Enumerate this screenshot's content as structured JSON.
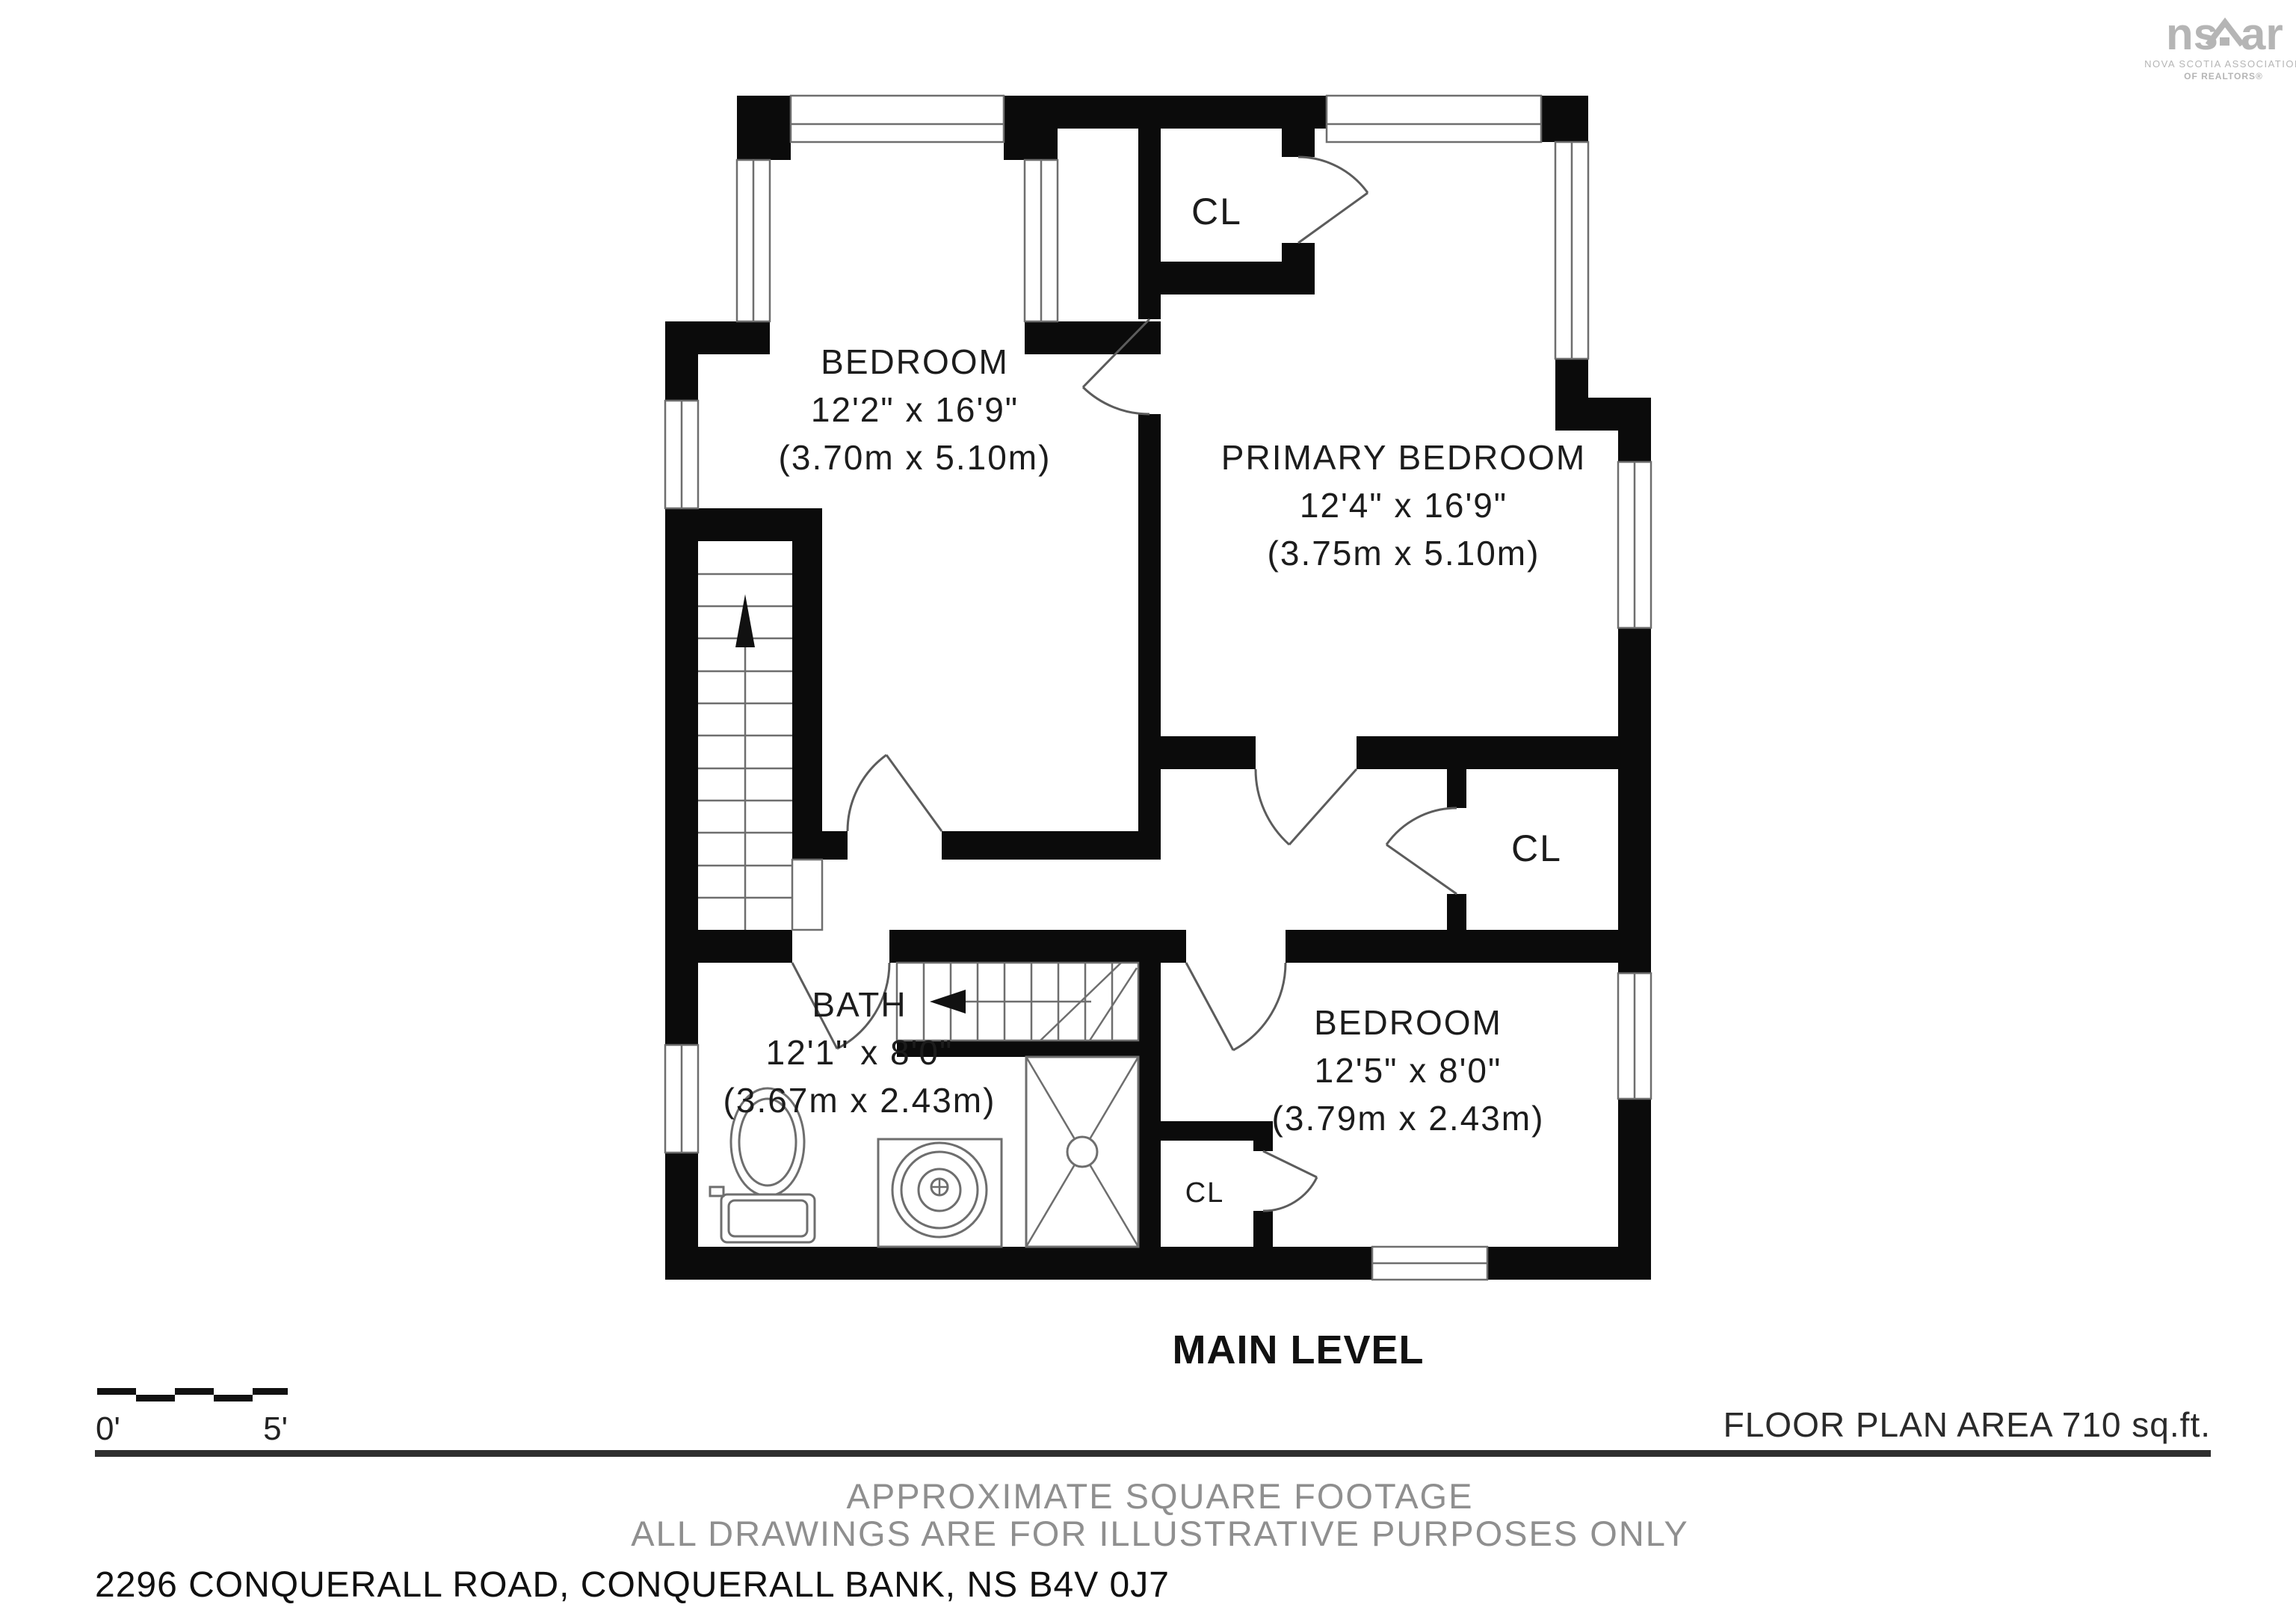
{
  "logo": {
    "brand_left": "ns",
    "brand_right": "ar",
    "caption_line1": "NOVA SCOTIA ASSOCIATION",
    "caption_line2": "OF REALTORS®"
  },
  "rooms": {
    "bedroom_top": {
      "name": "BEDROOM",
      "dims_ft": "12'2\" x 16'9\"",
      "dims_m": "(3.70m x 5.10m)"
    },
    "primary_bedroom": {
      "name": "PRIMARY BEDROOM",
      "dims_ft": "12'4\" x 16'9\"",
      "dims_m": "(3.75m x 5.10m)"
    },
    "bath": {
      "name": "BATH",
      "dims_ft": "12'1\" x 8'0\"",
      "dims_m": "(3.67m x 2.43m)"
    },
    "bedroom_bottom": {
      "name": "BEDROOM",
      "dims_ft": "12'5\" x 8'0\"",
      "dims_m": "(3.79m x 2.43m)"
    },
    "closet_top": {
      "label": "CL"
    },
    "closet_mid": {
      "label": "CL"
    },
    "closet_bottom": {
      "label": "CL"
    }
  },
  "level_label": "MAIN LEVEL",
  "floor_area_label": "FLOOR PLAN AREA 710 sq.ft.",
  "scale_bar": {
    "start_label": "0'",
    "end_label": "5'"
  },
  "footer": {
    "line1": "APPROXIMATE SQUARE FOOTAGE",
    "line2": "ALL DRAWINGS ARE FOR ILLUSTRATIVE PURPOSES ONLY",
    "address": "2296 CONQUERALL ROAD, CONQUERALL BANK, NS B4V 0J7"
  },
  "colors": {
    "wall": "#0b0b0b",
    "thin_line": "#6e6e6e",
    "muted_text": "#8f8f8f",
    "logo_gray": "#b5b5b5",
    "text": "#1c1c1c"
  }
}
